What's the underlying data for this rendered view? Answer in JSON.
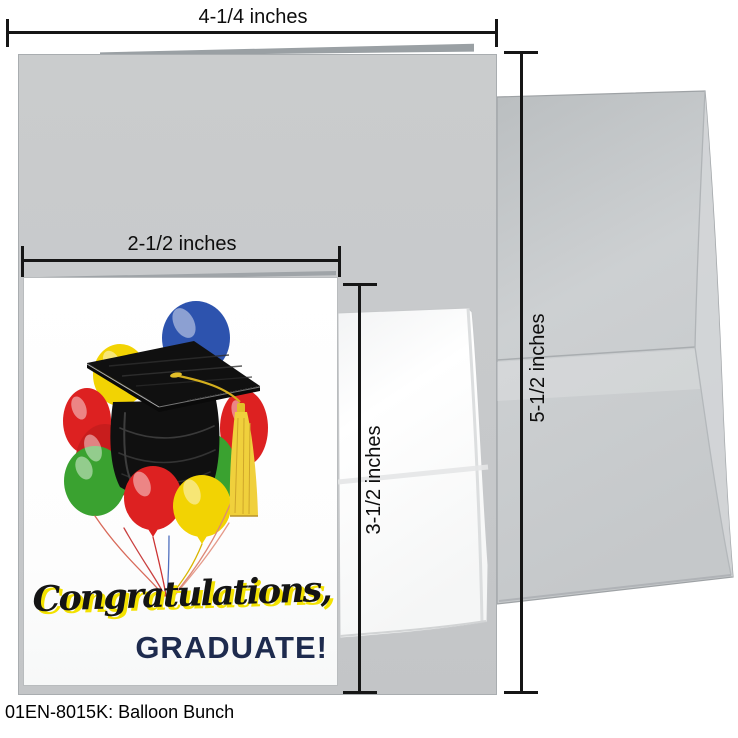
{
  "caption": "01EN-8015K: Balloon Bunch",
  "dimensions": {
    "card_width": "4-1/4 inches",
    "front_panel_width": "2-1/2 inches",
    "card_height": "5-1/2 inches",
    "front_panel_height": "3-1/2 inches"
  },
  "card_front": {
    "greeting_line1": "Congratulations,",
    "greeting_line2": "GRADUATE!"
  },
  "artwork": {
    "name": "balloon-bunch-with-graduation-cap",
    "colors": {
      "blue": "#2d53ae",
      "yellow": "#f2d303",
      "red": "#dd2121",
      "red_dark": "#c81d1d",
      "green": "#3aa230",
      "tassel_gold": "#f0d03c",
      "cap_black": "#101010",
      "script_black": "#141414",
      "script_shadow_yellow": "#f3e200",
      "graduate_navy": "#1e2b4e"
    }
  }
}
